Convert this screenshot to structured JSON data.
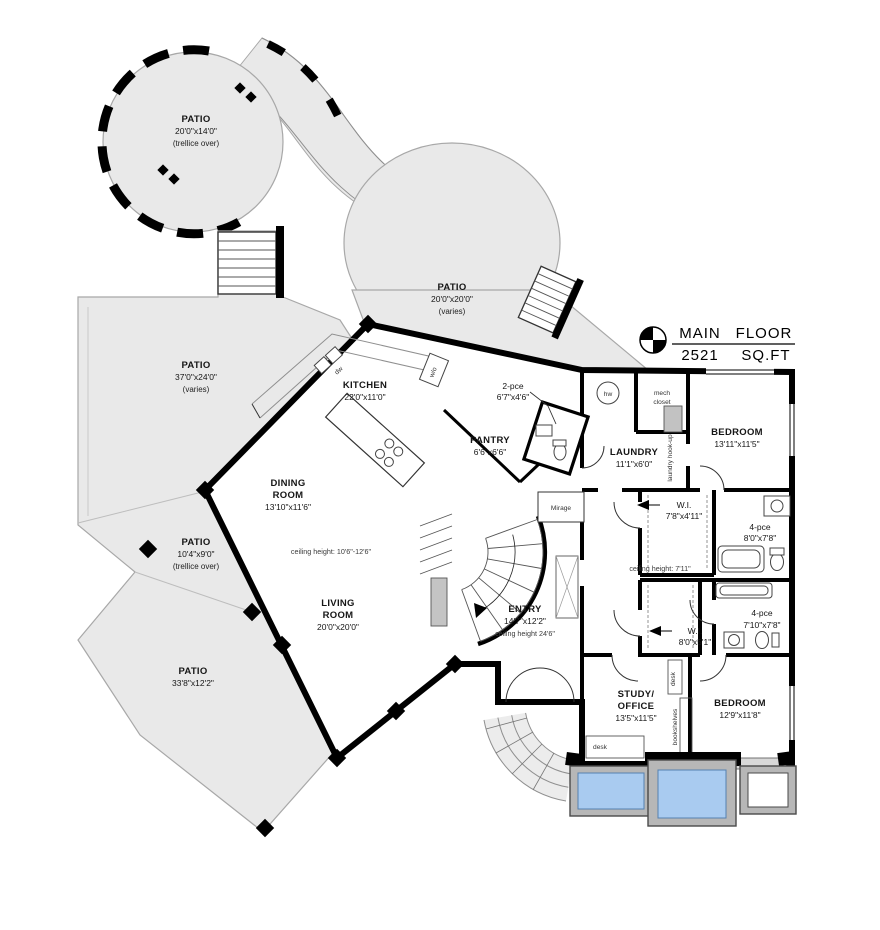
{
  "title_block": {
    "line1_left": "MAIN",
    "line1_right": "FLOOR",
    "line2_left": "2521",
    "line2_right": "SQ.FT"
  },
  "patios": {
    "upper_left": {
      "name": "PATIO",
      "dims": "20'0\"x14'0\"",
      "note": "(trellice over)"
    },
    "center": {
      "name": "PATIO",
      "dims": "20'0\"x20'0\"",
      "note": "(varies)"
    },
    "west": {
      "name": "PATIO",
      "dims": "37'0\"x24'0\"",
      "note": "(varies)"
    },
    "small_west": {
      "name": "PATIO",
      "dims": "10'4\"x9'0\"",
      "note": "(trellice over)"
    },
    "south": {
      "name": "PATIO",
      "dims": "33'8\"x12'2\""
    }
  },
  "rooms": {
    "kitchen": {
      "name": "KITCHEN",
      "dims": "22'0\"x11'0\""
    },
    "pantry": {
      "name": "PANTRY",
      "dims": "6'6\"x6'6\""
    },
    "powder": {
      "name": "2-pce",
      "dims": "6'7\"x4'6\""
    },
    "laundry": {
      "name": "LAUNDRY",
      "dims": "11'1\"x6'0\""
    },
    "bedroom_ne": {
      "name": "BEDROOM",
      "dims": "13'11\"x11'5\""
    },
    "wi_north": {
      "name": "W.I.",
      "dims": "7'8\"x4'11\""
    },
    "bath_north": {
      "name": "4-pce",
      "dims": "8'0\"x7'8\""
    },
    "wi_south": {
      "name": "W.I.",
      "dims": "8'0\"x5'1\""
    },
    "bath_south": {
      "name": "4-pce",
      "dims": "7'10\"x7'8\""
    },
    "dining": {
      "name1": "DINING",
      "name2": "ROOM",
      "dims": "13'10\"x11'6\""
    },
    "living": {
      "name1": "LIVING",
      "name2": "ROOM",
      "dims": "20'0\"x20'0\""
    },
    "entry": {
      "name": "ENTRY",
      "dims": "14'7\"x12'2\"",
      "ceiling": "ceiling height 24'6\""
    },
    "study": {
      "name1": "STUDY/",
      "name2": "OFFICE",
      "dims": "13'5\"x11'5\""
    },
    "bedroom_se": {
      "name": "BEDROOM",
      "dims": "12'9\"x11'8\""
    }
  },
  "annotations": {
    "ceiling_main": "ceiling height: 10'6\"-12'6\"",
    "ceiling_hall": "ceiling height: 7'11\"",
    "mech_line1": "mech",
    "mech_line2": "closet",
    "hw": "hw",
    "laundry_hookup": "laundry hook-up",
    "mirage": "Mirage",
    "desk1": "desk",
    "desk2": "desk",
    "bookshelves": "bookshelves",
    "dw": "dw",
    "wo": "w/o"
  },
  "colors": {
    "patio_fill": "#e9e9e9",
    "wall": "#000000",
    "water": "#a9cbf0",
    "pool_deck": "#b7b7b7"
  }
}
